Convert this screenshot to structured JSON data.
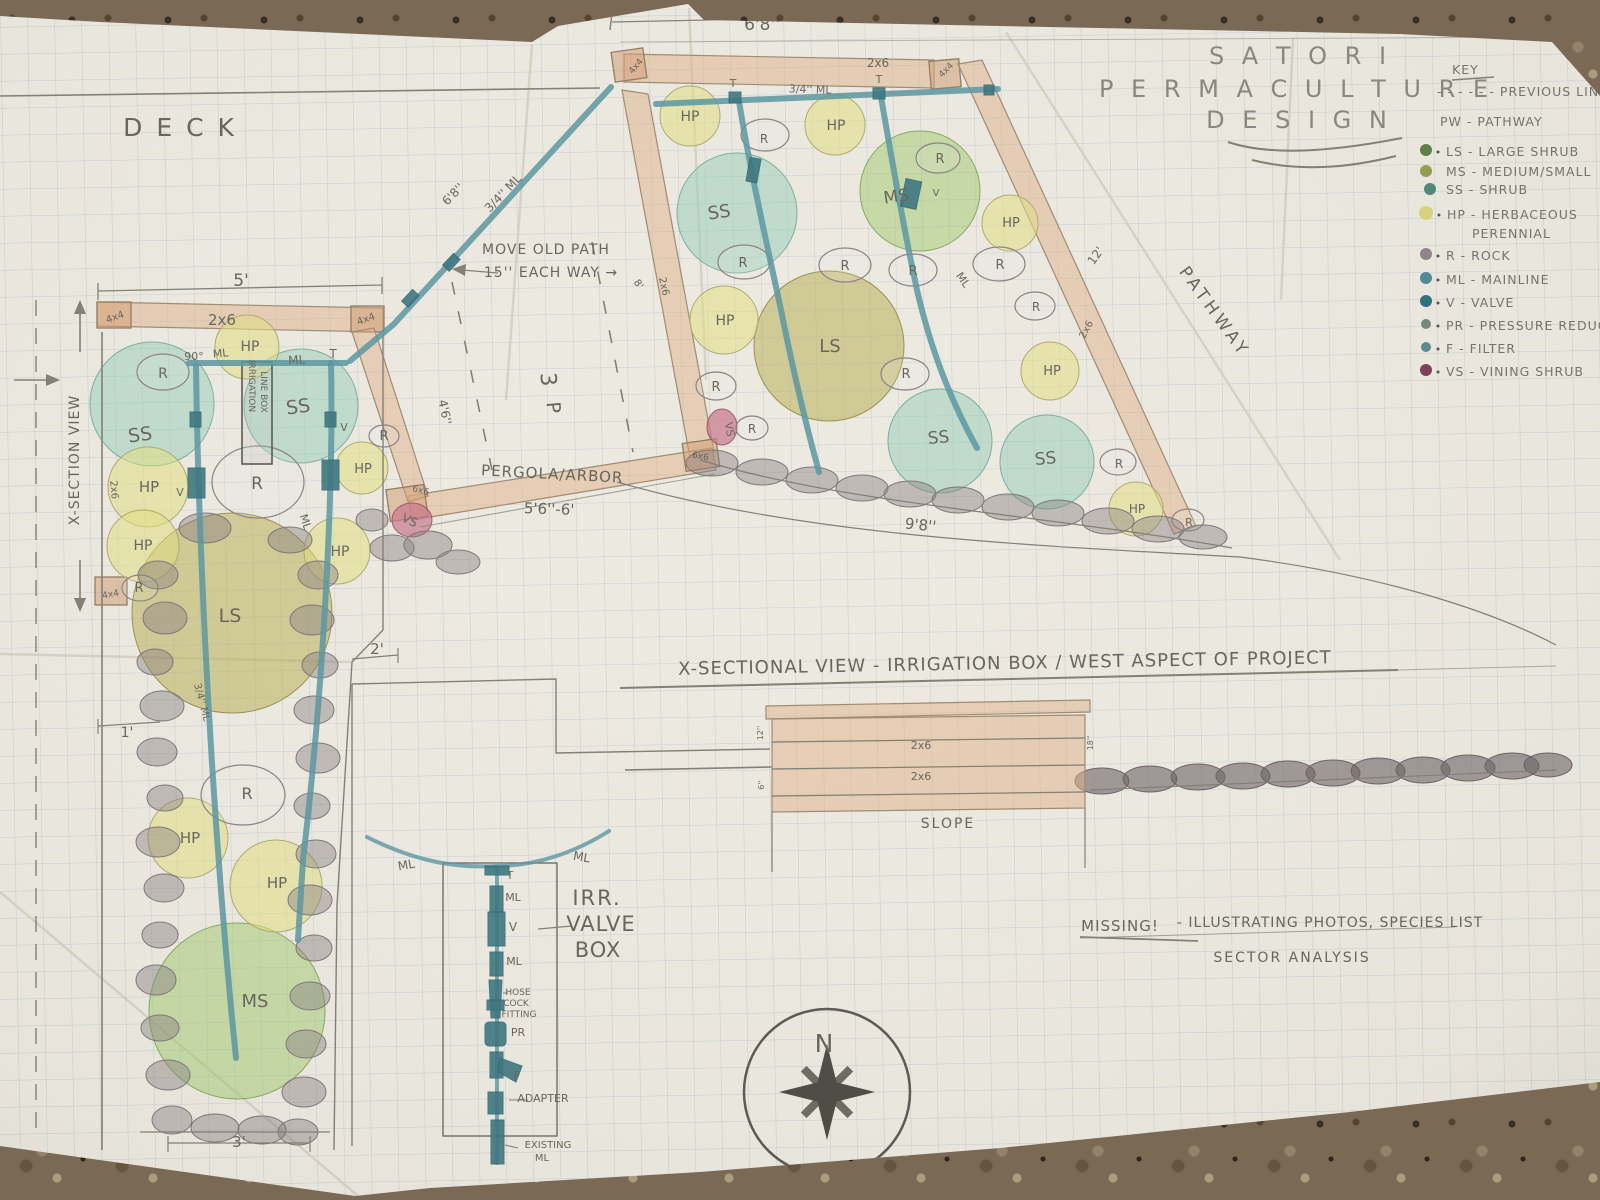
{
  "title": {
    "l1": "S A T O R I",
    "l2": "P E R M A C U L T U R E",
    "l3": "D E S I G N"
  },
  "key": {
    "heading": "KEY",
    "items": [
      {
        "label": "- - - - - -  PREVIOUS LINE",
        "dot": "none"
      },
      {
        "label": "PW - PATHWAY",
        "dot": "none"
      },
      {
        "label": "LS - LARGE SHRUB",
        "dot": "#5c7f46"
      },
      {
        "label": "MS - MEDIUM/SMALL",
        "dot": "#93a04e"
      },
      {
        "label": "SS -  SHRUB",
        "dot": "#4d8a77"
      },
      {
        "label": "HP - HERBACEOUS",
        "dot": "#d9d47e"
      },
      {
        "label": "PERENNIAL",
        "dot": "none"
      },
      {
        "label": "R - ROCK",
        "dot": "#8d8589"
      },
      {
        "label": "ML - MAINLINE",
        "dot": "#4e8a94"
      },
      {
        "label": "V - VALVE",
        "dot": "#2f6f7c"
      },
      {
        "label": "PR - PRESSURE REDUCER",
        "dot": "#77877d"
      },
      {
        "label": "F - FILTER",
        "dot": "#5d8a8f"
      },
      {
        "label": "VS - VINING SHRUB",
        "dot": "#7c3f56"
      }
    ]
  },
  "plan_labels": [
    {
      "t": "20' TOTAL RUN",
      "x": 398,
      "y": 13,
      "s": 19,
      "ls": 2
    },
    {
      "t": "6'8''",
      "x": 762,
      "y": 30,
      "s": 17
    },
    {
      "t": "D E C K",
      "x": 180,
      "y": 136,
      "s": 25,
      "ls": 3,
      "c": "#7b786e"
    },
    {
      "t": "5'",
      "x": 241,
      "y": 286,
      "s": 17
    },
    {
      "t": "4x4",
      "x": 116,
      "y": 320,
      "s": 10,
      "r": -20
    },
    {
      "t": "2x6",
      "x": 222,
      "y": 325,
      "s": 15
    },
    {
      "t": "4x4",
      "x": 367,
      "y": 322,
      "s": 10,
      "r": -20
    },
    {
      "t": "90°",
      "x": 194,
      "y": 360,
      "s": 11
    },
    {
      "t": "ML",
      "x": 221,
      "y": 357,
      "s": 11,
      "r": -6
    },
    {
      "t": "ML",
      "x": 297,
      "y": 364,
      "s": 12,
      "r": -4
    },
    {
      "t": "T",
      "x": 333,
      "y": 358,
      "s": 12
    },
    {
      "t": "HP",
      "x": 250,
      "y": 351,
      "s": 14
    },
    {
      "t": "R",
      "x": 163,
      "y": 378,
      "s": 14
    },
    {
      "t": "SS",
      "x": 141,
      "y": 441,
      "s": 19,
      "r": -8
    },
    {
      "t": "SS",
      "x": 299,
      "y": 413,
      "s": 19,
      "r": -8
    },
    {
      "t": "IRRIGATION",
      "x": 249,
      "y": 386,
      "s": 9,
      "r": 90
    },
    {
      "t": "LINE BOX",
      "x": 261,
      "y": 392,
      "s": 9,
      "r": 90
    },
    {
      "t": "V",
      "x": 180,
      "y": 496,
      "s": 11
    },
    {
      "t": "V",
      "x": 344,
      "y": 431,
      "s": 11
    },
    {
      "t": "R",
      "x": 384,
      "y": 440,
      "s": 13
    },
    {
      "t": "HP",
      "x": 149,
      "y": 492,
      "s": 15
    },
    {
      "t": "R",
      "x": 257,
      "y": 489,
      "s": 17
    },
    {
      "t": "HP",
      "x": 363,
      "y": 473,
      "s": 13
    },
    {
      "t": "2x6",
      "x": 111,
      "y": 490,
      "s": 10,
      "r": 85
    },
    {
      "t": "HP",
      "x": 143,
      "y": 550,
      "s": 14
    },
    {
      "t": "ML",
      "x": 302,
      "y": 523,
      "s": 11,
      "r": 72
    },
    {
      "t": "HP",
      "x": 340,
      "y": 556,
      "s": 14
    },
    {
      "t": "6x6",
      "x": 420,
      "y": 493,
      "s": 9,
      "r": 15
    },
    {
      "t": "VS",
      "x": 408,
      "y": 524,
      "s": 12,
      "r": 25,
      "c": "#8d3a50"
    },
    {
      "t": "R",
      "x": 139,
      "y": 592,
      "s": 13
    },
    {
      "t": "4x4",
      "x": 111,
      "y": 597,
      "s": 9,
      "r": -10
    },
    {
      "t": "LS",
      "x": 230,
      "y": 622,
      "s": 19
    },
    {
      "t": "2'",
      "x": 377,
      "y": 654,
      "s": 15
    },
    {
      "t": "1'",
      "x": 127,
      "y": 737,
      "s": 14
    },
    {
      "t": "3/4'' ML",
      "x": 199,
      "y": 703,
      "s": 10,
      "r": 75
    },
    {
      "t": "R",
      "x": 247,
      "y": 799,
      "s": 16
    },
    {
      "t": "HP",
      "x": 190,
      "y": 843,
      "s": 15
    },
    {
      "t": "HP",
      "x": 277,
      "y": 888,
      "s": 15
    },
    {
      "t": "MS",
      "x": 255,
      "y": 1007,
      "s": 18
    },
    {
      "t": "3'",
      "x": 239,
      "y": 1147,
      "s": 15
    },
    {
      "t": "X-SECTION VIEW",
      "x": 79,
      "y": 460,
      "s": 14,
      "r": -90,
      "ls": 1
    },
    {
      "t": "4x4",
      "x": 638,
      "y": 68,
      "s": 9,
      "r": -50
    },
    {
      "t": "2x6",
      "x": 878,
      "y": 67,
      "s": 12
    },
    {
      "t": "4x4",
      "x": 948,
      "y": 72,
      "s": 9,
      "r": -45
    },
    {
      "t": "3/4'' ML",
      "x": 810,
      "y": 93,
      "s": 11,
      "r": 2
    },
    {
      "t": "T",
      "x": 733,
      "y": 87,
      "s": 11
    },
    {
      "t": "T",
      "x": 879,
      "y": 83,
      "s": 11
    },
    {
      "t": "HP",
      "x": 690,
      "y": 121,
      "s": 14
    },
    {
      "t": "HP",
      "x": 836,
      "y": 130,
      "s": 14
    },
    {
      "t": "R",
      "x": 764,
      "y": 143,
      "s": 12
    },
    {
      "t": "R",
      "x": 940,
      "y": 163,
      "s": 13
    },
    {
      "t": "SS",
      "x": 720,
      "y": 218,
      "s": 18,
      "r": -8
    },
    {
      "t": "MS",
      "x": 897,
      "y": 202,
      "s": 17,
      "r": -8
    },
    {
      "t": "V",
      "x": 936,
      "y": 196,
      "s": 10
    },
    {
      "t": "HP",
      "x": 1011,
      "y": 227,
      "s": 13
    },
    {
      "t": "R",
      "x": 743,
      "y": 267,
      "s": 13
    },
    {
      "t": "R",
      "x": 845,
      "y": 270,
      "s": 13
    },
    {
      "t": "R",
      "x": 913,
      "y": 275,
      "s": 13
    },
    {
      "t": "R",
      "x": 1000,
      "y": 269,
      "s": 13
    },
    {
      "t": "ML",
      "x": 960,
      "y": 282,
      "s": 11,
      "r": 55
    },
    {
      "t": "LS",
      "x": 830,
      "y": 352,
      "s": 18
    },
    {
      "t": "HP",
      "x": 725,
      "y": 325,
      "s": 14
    },
    {
      "t": "2x6",
      "x": 661,
      "y": 287,
      "s": 10,
      "r": 78
    },
    {
      "t": "8'",
      "x": 636,
      "y": 286,
      "s": 10,
      "r": 55
    },
    {
      "t": "R",
      "x": 716,
      "y": 391,
      "s": 13
    },
    {
      "t": "VS",
      "x": 726,
      "y": 430,
      "s": 11,
      "r": 80,
      "c": "#8d3a50"
    },
    {
      "t": "R",
      "x": 752,
      "y": 433,
      "s": 12
    },
    {
      "t": "6x6",
      "x": 700,
      "y": 459,
      "s": 9,
      "r": 10
    },
    {
      "t": "R",
      "x": 906,
      "y": 378,
      "s": 13
    },
    {
      "t": "SS",
      "x": 939,
      "y": 443,
      "s": 17,
      "r": -5
    },
    {
      "t": "SS",
      "x": 1046,
      "y": 464,
      "s": 17,
      "r": -5
    },
    {
      "t": "R",
      "x": 1036,
      "y": 311,
      "s": 12
    },
    {
      "t": "HP",
      "x": 1052,
      "y": 375,
      "s": 13
    },
    {
      "t": "R",
      "x": 1119,
      "y": 468,
      "s": 12
    },
    {
      "t": "HP",
      "x": 1137,
      "y": 513,
      "s": 12
    },
    {
      "t": "R",
      "x": 1189,
      "y": 526,
      "s": 11
    },
    {
      "t": "9'8''",
      "x": 920,
      "y": 530,
      "s": 15,
      "r": 6
    },
    {
      "t": "12'",
      "x": 1099,
      "y": 258,
      "s": 12,
      "r": -55
    },
    {
      "t": "2x6",
      "x": 1089,
      "y": 331,
      "s": 10,
      "r": -62
    },
    {
      "t": "PATHWAY",
      "x": 1210,
      "y": 315,
      "s": 17,
      "r": 54,
      "ls": 4,
      "c": "#75726a"
    },
    {
      "t": "MOVE OLD PATH",
      "x": 546,
      "y": 254,
      "s": 14,
      "ls": 1
    },
    {
      "t": "15'' EACH WAY →",
      "x": 551,
      "y": 277,
      "s": 14,
      "ls": 1
    },
    {
      "t": "6'8''",
      "x": 456,
      "y": 197,
      "s": 12,
      "r": -46
    },
    {
      "t": "3/4'' ML",
      "x": 506,
      "y": 196,
      "s": 12,
      "r": -46
    },
    {
      "t": "3",
      "x": 541,
      "y": 380,
      "s": 22,
      "r": 85
    },
    {
      "t": "P",
      "x": 547,
      "y": 408,
      "s": 19,
      "r": 85
    },
    {
      "t": "4'6''",
      "x": 441,
      "y": 413,
      "s": 12,
      "r": 78
    },
    {
      "t": "PERGOLA/ARBOR",
      "x": 552,
      "y": 479,
      "s": 15,
      "r": 3,
      "ls": 1
    },
    {
      "t": "5'6''-6'",
      "x": 549,
      "y": 514,
      "s": 15,
      "r": 2
    },
    {
      "t": "X-SECTIONAL VIEW - IRRIGATION BOX / WEST ASPECT OF PROJECT",
      "x": 1005,
      "y": 669,
      "s": 18,
      "r": -1,
      "ls": 1,
      "c": "#5e5c55"
    },
    {
      "t": "2x6",
      "x": 921,
      "y": 749,
      "s": 11
    },
    {
      "t": "2x6",
      "x": 921,
      "y": 780,
      "s": 11
    },
    {
      "t": "12''",
      "x": 763,
      "y": 733,
      "s": 8,
      "r": -90
    },
    {
      "t": "18''",
      "x": 1093,
      "y": 743,
      "s": 8,
      "r": -90
    },
    {
      "t": "6''",
      "x": 764,
      "y": 785,
      "s": 8,
      "r": -90
    },
    {
      "t": "SLOPE",
      "x": 948,
      "y": 828,
      "s": 14,
      "ls": 2
    },
    {
      "t": "ML",
      "x": 407,
      "y": 869,
      "s": 12,
      "r": -10
    },
    {
      "t": "ML",
      "x": 581,
      "y": 861,
      "s": 12,
      "r": 10
    },
    {
      "t": "T",
      "x": 510,
      "y": 879,
      "s": 11
    },
    {
      "t": "ML",
      "x": 513,
      "y": 901,
      "s": 11
    },
    {
      "t": "V",
      "x": 513,
      "y": 931,
      "s": 12
    },
    {
      "t": "ML",
      "x": 514,
      "y": 965,
      "s": 11
    },
    {
      "t": "HOSE",
      "x": 518,
      "y": 995,
      "s": 9
    },
    {
      "t": "COCK",
      "x": 516,
      "y": 1006,
      "s": 9
    },
    {
      "t": "FITTING",
      "x": 519,
      "y": 1017,
      "s": 9
    },
    {
      "t": "PR",
      "x": 518,
      "y": 1036,
      "s": 11
    },
    {
      "t": "F",
      "x": 517,
      "y": 1080,
      "s": 12
    },
    {
      "t": "ADAPTER",
      "x": 543,
      "y": 1102,
      "s": 11
    },
    {
      "t": "EXISTING",
      "x": 548,
      "y": 1148,
      "s": 10
    },
    {
      "t": "ML",
      "x": 542,
      "y": 1161,
      "s": 10
    },
    {
      "t": "IRR.",
      "x": 597,
      "y": 905,
      "s": 21,
      "ls": 2
    },
    {
      "t": "VALVE",
      "x": 601,
      "y": 931,
      "s": 21,
      "ls": 1
    },
    {
      "t": "BOX",
      "x": 598,
      "y": 957,
      "s": 21,
      "ls": 1
    },
    {
      "t": "MISSING!",
      "x": 1120,
      "y": 931,
      "s": 15,
      "ls": 1
    },
    {
      "t": "- ILLUSTRATING PHOTOS, SPECIES LIST",
      "x": 1330,
      "y": 927,
      "s": 14,
      "ls": 1
    },
    {
      "t": "SECTOR ANALYSIS",
      "x": 1292,
      "y": 962,
      "s": 14,
      "ls": 2
    },
    {
      "t": "N",
      "x": 824,
      "y": 1052,
      "s": 25,
      "c": "#4a4843"
    }
  ]
}
